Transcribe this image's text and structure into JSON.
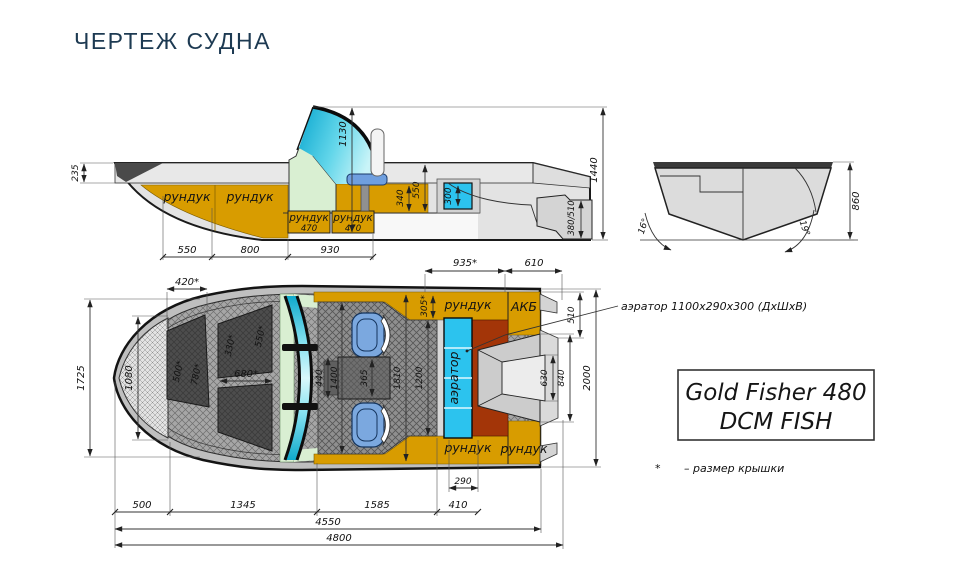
{
  "title": "ЧЕРТЕЖ СУДНА",
  "colors": {
    "title_navy": "#1d3a52",
    "deck_orange": "#d89c00",
    "aerator_blue": "#2cc3ee",
    "brick_red": "#a33508",
    "seat_blue": "#7ba8df",
    "glass_cyan": "#14b6da",
    "console_green": "#d9efd2"
  },
  "side_view": {
    "locker_bow_1": "рундук",
    "locker_bow_2": "рундук",
    "locker_boxes": [
      {
        "label": "рундук",
        "width": "470"
      },
      {
        "label": "рундук",
        "width": "470"
      }
    ],
    "dims": {
      "bow_freeboard": "235",
      "windshield_height": "1130",
      "seat_depth": "340",
      "cockpit_depth": "550",
      "livewell_height": "300",
      "transom_height": "380/510",
      "overall_height": "1440",
      "seg_1": "550",
      "seg_2": "800",
      "seg_3": "930"
    }
  },
  "transom_view": {
    "dims": {
      "height": "860",
      "deadrise_port": "16°",
      "deadrise_starboard": "19°"
    }
  },
  "top_view": {
    "labels": {
      "stern_locker_top": "рундук",
      "battery": "АКБ",
      "livewell": "аэратор",
      "stern_locker_bottom_left": "рундук",
      "stern_locker_bottom_right": "рундук"
    },
    "dims": {
      "bow_hatch_width": "420*",
      "bow_beam": "1725",
      "bow_inner": "1080",
      "hatch_500": "500*",
      "hatch_780": "780*",
      "hatch_330": "330*",
      "hatch_550": "550*",
      "hatch_680": "680*",
      "stern_locker_len": "935*",
      "battery_len": "610",
      "locker_width": "305*",
      "stern_width": "510",
      "well_inner": "630",
      "well_outer": "840",
      "transom_beam": "2000",
      "seat_gap": "440",
      "cockpit_width": "1400",
      "console_width": "365",
      "cockpit_inner": "1810",
      "floor_width": "1200",
      "livewell_width": "290",
      "livewell_zone": "410",
      "seg_1": "500",
      "seg_2": "1345",
      "seg_3": "1585",
      "length_hull": "4550",
      "length_overall": "4800"
    }
  },
  "annotation": {
    "aerator_note": "аэратор 1100х290х300 (ДхШхВ)"
  },
  "brand_plate": {
    "line1": "Gold Fisher 480",
    "line2": "DCM FISH"
  },
  "footnote": {
    "marker": "*",
    "text": "– размер крышки"
  }
}
